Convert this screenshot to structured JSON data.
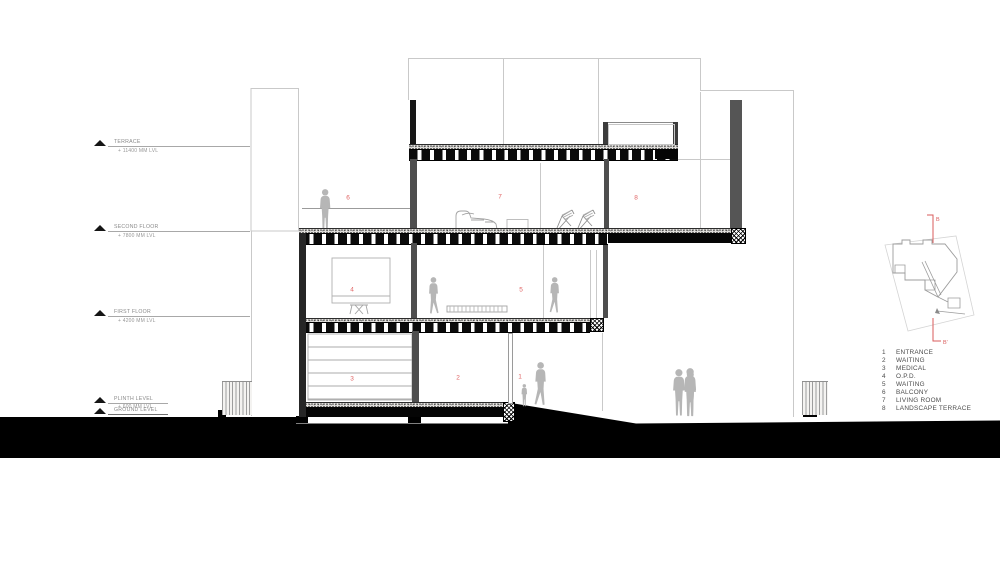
{
  "levels": [
    {
      "name": "TERRACE",
      "value": "+ 11400 MM LVL"
    },
    {
      "name": "SECOND FLOOR",
      "value": "+ 7800 MM LVL"
    },
    {
      "name": "FIRST FLOOR",
      "value": "+ 4200 MM LVL"
    },
    {
      "name": "PLINTH LEVEL",
      "value": "+ 600 MM LVL"
    },
    {
      "name": "GROUND LEVEL",
      "value": ""
    }
  ],
  "markers": [
    "1",
    "2",
    "3",
    "4",
    "5",
    "6",
    "7",
    "8"
  ],
  "legend": {
    "items": [
      {
        "num": "1",
        "label": "ENTRANCE"
      },
      {
        "num": "2",
        "label": "WAITING"
      },
      {
        "num": "3",
        "label": "MEDICAL"
      },
      {
        "num": "4",
        "label": "O.P.D."
      },
      {
        "num": "5",
        "label": "WAITING"
      },
      {
        "num": "6",
        "label": "BALCONY"
      },
      {
        "num": "7",
        "label": "LIVING ROOM"
      },
      {
        "num": "8",
        "label": "LANDSCAPE TERRACE"
      }
    ]
  },
  "keyplan": {
    "section_start": "B",
    "section_end": "B'"
  },
  "colors": {
    "marker_red": "#e06565",
    "figure_gray": "#b6b6b6",
    "wall_gray": "#4e4e4e",
    "wall_dark": "#1a1a1a",
    "ground": "#000000",
    "outline": "#c9c9c9"
  }
}
